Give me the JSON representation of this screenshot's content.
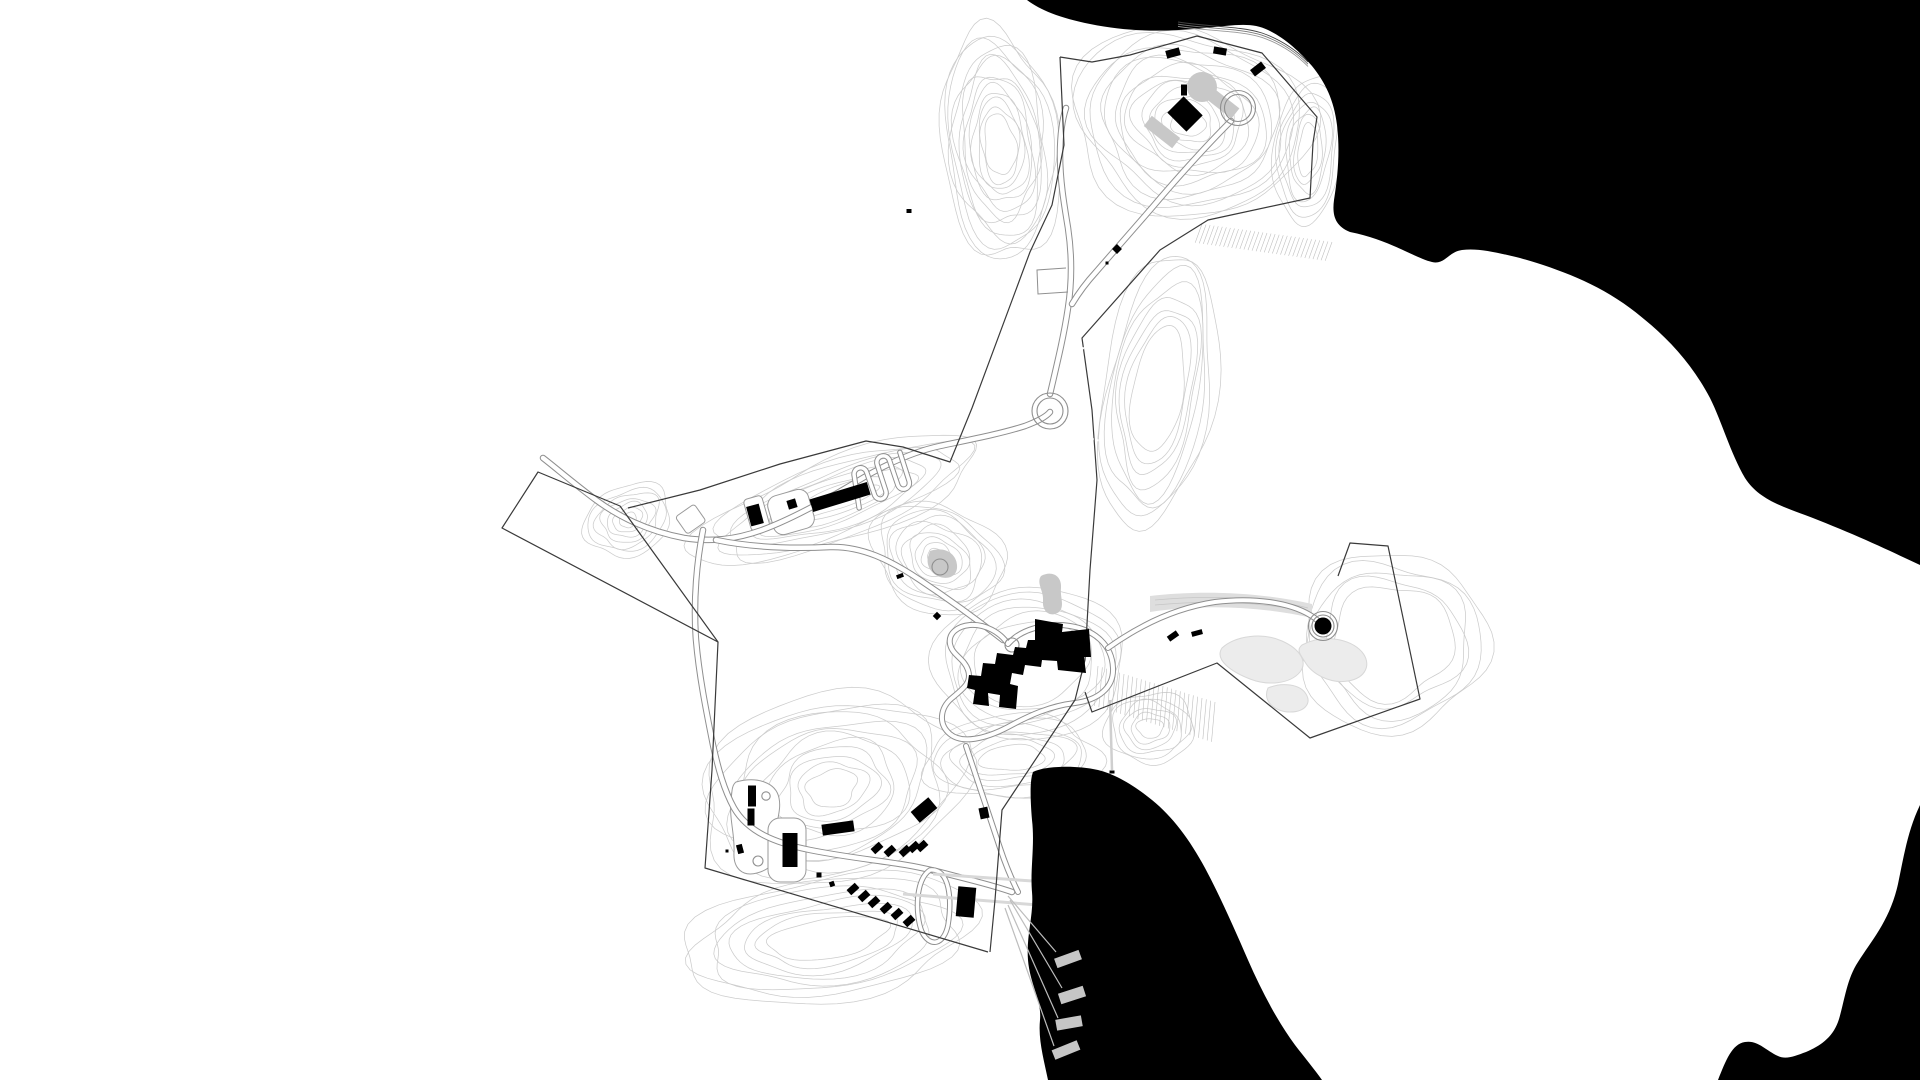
{
  "title": "site-plan-drawing",
  "canvas": {
    "width": 1920,
    "height": 1080,
    "background": "#ffffff"
  },
  "colors": {
    "water": "#000000",
    "building": "#000000",
    "contour": "#cccccc",
    "road_casing": "#8f8f8f",
    "road_fill": "#ffffff",
    "boundary": "#3a3a3a",
    "gray_surface": "#c8c8c8",
    "pond_light": "#ececec",
    "pond_stroke": "#d8d8d8",
    "band": "#dedede",
    "path_light": "#d8d8d8",
    "fan_line": "#bdbdbd",
    "pier": "#c6c6c6",
    "hatch": "#bfbfbf",
    "white_bldg_stroke": "#9a9a9a",
    "dash_white": "#ffffff"
  },
  "water_bodies": [
    {
      "name": "water-northeast-sea",
      "d": "M1027,0 C1040,10 1060,18 1090,24 C1130,32 1165,32 1205,28 C1235,25 1252,22 1268,30 C1285,38 1300,52 1312,66 C1325,82 1334,100 1337,125 C1340,150 1338,175 1334,200 C1332,215 1335,226 1350,232 C1390,240 1415,258 1432,262 C1445,265 1448,252 1462,250 C1478,248 1495,252 1520,258 C1555,268 1595,282 1630,308 C1662,332 1690,360 1710,398 C1722,422 1730,452 1745,478 C1758,498 1778,505 1805,515 C1842,529 1880,546 1905,558 L1920,565 L1920,0 Z"
    },
    {
      "name": "water-south-bay",
      "d": "M1033,772 C1045,766 1075,765 1098,770 C1115,774 1135,786 1152,800 C1172,816 1190,840 1205,868 C1220,896 1235,930 1248,960 C1262,992 1278,1022 1295,1045 C1305,1058 1315,1070 1322,1080 L1048,1080 C1044,1060 1038,1040 1040,1020 C1042,1000 1030,985 1028,960 C1026,935 1034,915 1032,892 C1030,870 1035,845 1032,820 C1030,795 1030,780 1033,772 Z"
    },
    {
      "name": "water-southeast-sea",
      "d": "M1920,805 C1908,830 1904,855 1898,884 C1890,920 1872,940 1858,962 C1846,980 1844,1005 1838,1022 C1832,1038 1820,1046 1806,1052 C1795,1056 1786,1060 1778,1056 C1765,1050 1758,1040 1745,1042 C1732,1044 1726,1060 1718,1080 L1920,1080 Z"
    }
  ],
  "shoreline_strokes": [
    {
      "d": "M1178,22 C1210,27 1240,26 1262,33 C1282,40 1296,50 1308,62",
      "dy": 0,
      "c": "#444444"
    },
    {
      "d": "M1178,22 C1210,27 1240,26 1262,33 C1282,40 1296,50 1308,62",
      "dy": 2.2,
      "c": "#777777"
    },
    {
      "d": "M1178,22 C1210,27 1240,26 1262,33 C1282,40 1296,50 1308,62",
      "dy": 4.4,
      "c": "#999999"
    }
  ],
  "contour_fields": [
    {
      "name": "contours-north-west",
      "cx": 1000,
      "cy": 145,
      "rx0": 16,
      "ry0": 30,
      "rx1": 58,
      "ry1": 118,
      "n": 13,
      "rot": -6,
      "wob": 1,
      "seed": 11
    },
    {
      "name": "contours-north-hilltop",
      "cx": 1188,
      "cy": 122,
      "rx0": 18,
      "ry0": 14,
      "rx1": 118,
      "ry1": 96,
      "n": 15,
      "rot": 12,
      "wob": 1,
      "seed": 22
    },
    {
      "name": "contours-nw-ridge",
      "cx": 838,
      "cy": 500,
      "rx0": 42,
      "ry0": 9,
      "rx1": 148,
      "ry1": 42,
      "n": 9,
      "rot": -20,
      "wob": 1,
      "seed": 33
    },
    {
      "name": "contours-west-knob",
      "cx": 628,
      "cy": 520,
      "rx0": 9,
      "ry0": 7,
      "rx1": 46,
      "ry1": 34,
      "n": 7,
      "rot": -25,
      "wob": 1,
      "seed": 44
    },
    {
      "name": "contours-central-knoll",
      "cx": 938,
      "cy": 558,
      "rx0": 11,
      "ry0": 9,
      "rx1": 68,
      "ry1": 54,
      "n": 10,
      "rot": 25,
      "wob": 1,
      "seed": 55
    },
    {
      "name": "contours-building-hill",
      "cx": 1030,
      "cy": 663,
      "rx0": 58,
      "ry0": 42,
      "rx1": 96,
      "ry1": 76,
      "n": 6,
      "rot": -8,
      "wob": 0.7,
      "seed": 66
    },
    {
      "name": "contours-south-of-bldg",
      "cx": 1012,
      "cy": 758,
      "rx0": 32,
      "ry0": 13,
      "rx1": 88,
      "ry1": 42,
      "n": 7,
      "rot": -4,
      "wob": 1,
      "seed": 77
    },
    {
      "name": "contours-ne-mid-slope",
      "cx": 1158,
      "cy": 390,
      "rx0": 26,
      "ry0": 62,
      "rx1": 56,
      "ry1": 140,
      "n": 8,
      "rot": 10,
      "wob": 0.8,
      "seed": 88
    },
    {
      "name": "contours-sw-hill",
      "cx": 832,
      "cy": 788,
      "rx0": 26,
      "ry0": 18,
      "rx1": 138,
      "ry1": 92,
      "n": 12,
      "rot": -15,
      "wob": 1,
      "seed": 99
    },
    {
      "name": "contours-south-slope",
      "cx": 828,
      "cy": 938,
      "rx0": 60,
      "ry0": 20,
      "rx1": 148,
      "ry1": 62,
      "n": 8,
      "rot": -8,
      "wob": 1,
      "seed": 110
    },
    {
      "name": "contours-east-rim",
      "cx": 1392,
      "cy": 642,
      "rx0": 62,
      "ry0": 56,
      "rx1": 96,
      "ry1": 88,
      "n": 5,
      "rot": 0,
      "wob": 1,
      "seed": 121
    },
    {
      "name": "contours-marina-knoll",
      "cx": 1150,
      "cy": 728,
      "rx0": 13,
      "ry0": 10,
      "rx1": 44,
      "ry1": 36,
      "n": 6,
      "rot": 0,
      "wob": 1,
      "seed": 132
    },
    {
      "name": "contours-ne-pocket",
      "cx": 1308,
      "cy": 150,
      "rx0": 10,
      "ry0": 26,
      "rx1": 34,
      "ry1": 74,
      "n": 7,
      "rot": 5,
      "wob": 0.8,
      "seed": 143
    }
  ],
  "hatch_bands": [
    {
      "name": "hatch-ne-coast",
      "x1": 1202,
      "y1": 224,
      "x2": 1332,
      "y2": 242,
      "len": 20,
      "angle": 110,
      "step": 4
    },
    {
      "name": "hatch-mid-east",
      "x1": 1098,
      "y1": 666,
      "x2": 1215,
      "y2": 702,
      "len": 40,
      "angle": 95,
      "step": 4.5
    }
  ],
  "gray_shapes": [
    {
      "name": "hilltop-plaza-circle",
      "type": "circle",
      "cx": 1202,
      "cy": 87,
      "r": 15,
      "fill": "#c8c8c8"
    },
    {
      "name": "hilltop-ramp-east",
      "type": "rect",
      "cx": 1222,
      "cy": 103,
      "w": 34,
      "h": 13,
      "rot": 38,
      "fill": "#c8c8c8"
    },
    {
      "name": "hilltop-ramp-west",
      "type": "rect",
      "cx": 1162,
      "cy": 132,
      "w": 36,
      "h": 13,
      "rot": 38,
      "fill": "#c8c8c8"
    },
    {
      "name": "pond-central",
      "type": "path",
      "d": "M1041,576 C1052,570 1062,576 1061,588 C1060,598 1065,606 1059,612 C1051,618 1042,612 1043,601 C1044,591 1036,583 1041,576 Z",
      "fill": "#c8c8c8"
    },
    {
      "name": "pond-knoll",
      "type": "path",
      "d": "M930,551 C944,546 956,553 957,565 C958,575 950,580 940,577 C931,574 926,565 928,557 Z",
      "fill": "#c8c8c8"
    },
    {
      "name": "east-track-band",
      "type": "path",
      "d": "M1150,596 C1200,590 1260,592 1312,604 L1312,618 C1260,606 1200,604 1150,612 Z",
      "fill": "#dedede"
    },
    {
      "name": "pond-east-1",
      "type": "path",
      "d": "M1222,648 C1235,636 1262,632 1282,641 C1300,649 1308,662 1300,672 C1290,684 1268,686 1250,679 C1232,672 1214,660 1222,648 Z",
      "fill": "#ececec",
      "stroke": "#d8d8d8"
    },
    {
      "name": "pond-east-2",
      "type": "path",
      "d": "M1302,645 C1322,634 1350,638 1362,652 C1372,664 1366,678 1348,681 C1330,684 1312,674 1305,662 C1300,654 1296,650 1302,645 Z",
      "fill": "#ececec",
      "stroke": "#d8d8d8"
    },
    {
      "name": "pond-east-3",
      "type": "path",
      "d": "M1268,688 C1282,682 1300,684 1306,694 C1312,704 1304,712 1290,712 C1276,712 1262,702 1268,688 Z",
      "fill": "#ececec",
      "stroke": "#d8d8d8"
    }
  ],
  "band_streaks": [
    {
      "d": "M1155,600 C1210,595 1265,597 1308,608"
    },
    {
      "d": "M1155,605 C1210,600 1265,602 1305,612"
    }
  ],
  "white_buildings": [
    {
      "name": "plaza-mid-row",
      "type": "rect",
      "x": 770,
      "y": 492,
      "w": 42,
      "h": 40,
      "rx": 10,
      "rot": -16,
      "cx": 791,
      "cy": 512
    },
    {
      "name": "white-bldg-left",
      "type": "rect",
      "x": 747,
      "y": 497,
      "w": 19,
      "h": 33,
      "rx": 4,
      "rot": -16,
      "cx": 756,
      "cy": 513
    },
    {
      "name": "white-bldg-far-left",
      "type": "rect",
      "x": 679,
      "y": 509,
      "w": 23,
      "h": 21,
      "rx": 3,
      "rot": -35,
      "cx": 690,
      "cy": 519
    },
    {
      "name": "sw-plaza-north",
      "type": "path",
      "d": "M736,782 C758,776 776,783 779,798 C782,812 774,824 777,840 C780,857 773,869 757,873 C742,877 733,868 734,852 C735,835 729,818 731,801 C732,790 732,785 736,782 Z"
    },
    {
      "name": "sw-plaza-south",
      "type": "rect",
      "x": 768,
      "y": 818,
      "w": 38,
      "h": 64,
      "rx": 12,
      "rot": 0,
      "cx": 787,
      "cy": 850
    }
  ],
  "roads": [
    {
      "name": "road-west-main",
      "w": 4.5,
      "d": "M543,458 C556,468 572,482 596,500 C622,519 652,532 684,538 C710,542 734,540 762,530 C792,519 826,500 856,482 C884,465 912,452 940,446 C968,440 1000,434 1025,426 C1038,421 1046,417 1050,412"
    },
    {
      "name": "road-central-access",
      "w": 4.5,
      "d": "M716,540 C750,547 790,549 830,547 C862,546 890,560 920,580 C950,600 980,622 1003,640"
    },
    {
      "name": "road-north",
      "w": 4.5,
      "d": "M1050,394 C1058,360 1064,335 1068,308 C1072,282 1072,255 1068,228 C1064,204 1060,180 1060,155 C1060,135 1062,120 1066,108"
    },
    {
      "name": "road-serpentine-hill",
      "w": 4.5,
      "d": "M1231,121 C1210,142 1188,166 1162,196 C1140,222 1115,250 1096,272 C1085,284 1078,294 1072,304"
    },
    {
      "name": "road-central-loop",
      "w": 4,
      "d": "M1008,644 C1020,630 1045,622 1070,626 C1095,630 1112,645 1113,668 C1114,688 1098,700 1075,703 C1050,706 1030,715 1008,727 C985,739 962,744 950,734 C938,724 940,708 952,698 C964,688 972,682 968,670 C964,658 952,655 950,644 C948,633 958,626 970,625 C985,624 1000,632 1008,644 Z"
    },
    {
      "name": "road-to-silo",
      "w": 4,
      "d": "M1108,648 C1140,625 1175,608 1215,602 C1255,597 1290,603 1310,615 C1317,619 1320,622 1322,626"
    },
    {
      "name": "road-southwest",
      "w": 4.5,
      "d": "M703,530 C697,560 693,600 696,640 C699,675 706,710 713,745 C718,768 724,790 734,808 C748,832 775,843 810,850 C845,857 875,860 900,864 C920,867 940,872 955,876 C975,881 995,886 1012,892"
    },
    {
      "name": "road-loop-to-marina",
      "w": 4,
      "d": "M966,746 C978,782 990,818 1000,848 C1006,866 1012,880 1018,892"
    },
    {
      "name": "road-sw-oval-loop",
      "w": 3.5,
      "d": "M930,870 C950,868 952,900 948,925 C944,945 930,948 922,932 C915,915 915,880 930,870 Z"
    },
    {
      "name": "road-switchback",
      "w": 3.5,
      "d": "M853,502 L856,470 C856,461 869,461 869,470 L871,492 C871,501 883,501 883,492 L881,464 C881,455 894,455 894,464 L896,488 C896,497 908,497 908,488 L906,458",
      "transform": "rotate(-14 880 480)"
    }
  ],
  "road_circles": [
    {
      "name": "hilltop-loop-outer",
      "cx": 1238,
      "cy": 108,
      "r": 17.5
    },
    {
      "name": "hilltop-loop-inner",
      "cx": 1238,
      "cy": 108,
      "r": 13.5
    },
    {
      "name": "turning-circle-outer",
      "cx": 1050,
      "cy": 411,
      "r": 18
    },
    {
      "name": "turning-circle-inner",
      "cx": 1050,
      "cy": 411,
      "r": 13
    },
    {
      "name": "roundabout",
      "cx": 1012,
      "cy": 645,
      "r": 7
    },
    {
      "name": "knoll-circle",
      "cx": 940,
      "cy": 567,
      "r": 8
    },
    {
      "name": "sw-circle-small",
      "cx": 766,
      "cy": 796,
      "r": 4.2
    },
    {
      "name": "sw-circle-lower",
      "cx": 758,
      "cy": 861,
      "r": 5
    },
    {
      "name": "silo-ring-outer",
      "cx": 1323,
      "cy": 626,
      "r": 14.5
    },
    {
      "name": "silo-ring-inner",
      "cx": 1323,
      "cy": 626,
      "r": 11
    }
  ],
  "thin_lines": [
    {
      "name": "plateau-spur",
      "d": "M1066,268 L1037,270 L1038,294 L1068,292",
      "c": "#8f8f8f",
      "w": 1
    },
    {
      "name": "shore-path-east",
      "d": "M1110,700 L1112,770",
      "c": "#cfcfcf",
      "w": 2.5
    }
  ],
  "light_paths": [
    {
      "name": "marina-path-1",
      "d": "M933,874 L1047,882",
      "w": 3
    },
    {
      "name": "marina-path-2",
      "d": "M903,894 L1050,906",
      "w": 3
    }
  ],
  "fan_lines": [
    {
      "d": "M1008,896 L1056,952"
    },
    {
      "d": "M1010,900 L1062,988"
    },
    {
      "d": "M1008,905 L1058,1018"
    },
    {
      "d": "M1005,908 L1054,1046"
    }
  ],
  "piers": [
    {
      "cx": 1068,
      "cy": 959,
      "w": 26,
      "h": 10,
      "rot": -20
    },
    {
      "cx": 1072,
      "cy": 995,
      "w": 26,
      "h": 11,
      "rot": -18
    },
    {
      "cx": 1069,
      "cy": 1023,
      "w": 26,
      "h": 11,
      "rot": -10
    },
    {
      "cx": 1066,
      "cy": 1050,
      "w": 27,
      "h": 10,
      "rot": -22
    }
  ],
  "boundary_lines": [
    {
      "name": "boundary-west-chain",
      "d": "M1060,57 L1064,145 L1052,205 L1030,252 L972,408 L950,462 L903,447 L866,441 L780,464 L700,490 L628,508"
    },
    {
      "name": "boundary-wedge",
      "d": "M538,472 L502,528 L718,642 L620,506 Z"
    },
    {
      "name": "boundary-southwest",
      "d": "M718,642 L712,770 L705,868 L988,952"
    },
    {
      "name": "boundary-northeast-chain",
      "d": "M1060,57 L1092,62 L1130,55 L1197,36 L1262,53 L1317,117 L1313,143 L1310,198 L1208,220 L1160,250 L1082,338 L1092,410 L1097,480 L1090,570 L1085,660 L1075,700 L1002,810 L995,900 L990,952"
    },
    {
      "name": "boundary-east-field",
      "d": "M1085,692 L1092,712 L1217,663 L1310,738 L1420,699 L1388,546 L1350,543 L1338,576"
    }
  ],
  "buildings": {
    "central_polygon": "M1035,619 L1063,624 L1062,632 L1089,629 L1091,657 L1084,657 L1086,673 L1058,670 L1057,661 L1042,660 L1041,667 L1025,665 L1023,675 L1012,673 L1010,684 L1018,686 L1016,709 L999,707 L1000,695 L988,693 L989,706 L973,704 L975,690 L967,688 L969,675 L981,676 L983,663 L995,664 L997,653 L1013,655 L1015,647 L1026,648 L1028,640 L1035,640 Z",
    "rects": [
      {
        "cx": 1173,
        "cy": 53,
        "w": 14,
        "h": 8,
        "rot": -15
      },
      {
        "cx": 1220,
        "cy": 51,
        "w": 13,
        "h": 7,
        "rot": 10
      },
      {
        "cx": 1258,
        "cy": 69,
        "w": 14,
        "h": 8,
        "rot": -38
      },
      {
        "cx": 1184,
        "cy": 90,
        "w": 6,
        "h": 11,
        "rot": 0
      },
      {
        "cx": 1185,
        "cy": 114,
        "w": 27,
        "h": 23,
        "rot": 45
      },
      {
        "cx": 840,
        "cy": 497,
        "w": 60,
        "h": 13,
        "rot": -17
      },
      {
        "cx": 792,
        "cy": 504,
        "w": 9,
        "h": 9,
        "rot": -17
      },
      {
        "cx": 755,
        "cy": 515,
        "w": 13,
        "h": 20,
        "rot": -15
      },
      {
        "cx": 900,
        "cy": 576,
        "w": 7,
        "h": 4,
        "rot": -20
      },
      {
        "cx": 937,
        "cy": 616,
        "w": 6,
        "h": 6,
        "rot": 45
      },
      {
        "cx": 1173,
        "cy": 636,
        "w": 11,
        "h": 6,
        "rot": -35
      },
      {
        "cx": 1197,
        "cy": 633,
        "w": 11,
        "h": 5,
        "rot": -15
      },
      {
        "cx": 752,
        "cy": 796,
        "w": 8,
        "h": 21,
        "rot": 0
      },
      {
        "cx": 751,
        "cy": 817,
        "w": 7,
        "h": 17,
        "rot": 0
      },
      {
        "cx": 740,
        "cy": 849,
        "w": 6,
        "h": 9,
        "rot": -15
      },
      {
        "cx": 727,
        "cy": 851,
        "w": 3,
        "h": 3,
        "rot": 0
      },
      {
        "cx": 790,
        "cy": 850,
        "w": 15,
        "h": 34,
        "rot": 0
      },
      {
        "cx": 838,
        "cy": 828,
        "w": 32,
        "h": 11,
        "rot": -8
      },
      {
        "cx": 924,
        "cy": 810,
        "w": 23,
        "h": 14,
        "rot": -40
      },
      {
        "cx": 984,
        "cy": 813,
        "w": 9,
        "h": 11,
        "rot": -12
      },
      {
        "cx": 966,
        "cy": 902,
        "w": 18,
        "h": 30,
        "rot": 5
      },
      {
        "cx": 877,
        "cy": 848,
        "w": 11,
        "h": 7,
        "rot": -42
      },
      {
        "cx": 890,
        "cy": 851,
        "w": 11,
        "h": 7,
        "rot": -42
      },
      {
        "cx": 905,
        "cy": 851,
        "w": 11,
        "h": 7,
        "rot": -42
      },
      {
        "cx": 914,
        "cy": 847,
        "w": 11,
        "h": 7,
        "rot": -42
      },
      {
        "cx": 922,
        "cy": 846,
        "w": 11,
        "h": 7,
        "rot": -42
      },
      {
        "cx": 853,
        "cy": 889,
        "w": 11,
        "h": 7,
        "rot": -42
      },
      {
        "cx": 864,
        "cy": 896,
        "w": 11,
        "h": 7,
        "rot": -42
      },
      {
        "cx": 874,
        "cy": 902,
        "w": 11,
        "h": 7,
        "rot": -42
      },
      {
        "cx": 886,
        "cy": 908,
        "w": 11,
        "h": 7,
        "rot": -42
      },
      {
        "cx": 897,
        "cy": 914,
        "w": 11,
        "h": 7,
        "rot": -42
      },
      {
        "cx": 909,
        "cy": 921,
        "w": 11,
        "h": 7,
        "rot": -42
      },
      {
        "cx": 819,
        "cy": 875,
        "w": 5,
        "h": 5,
        "rot": 0
      },
      {
        "cx": 832,
        "cy": 884,
        "w": 5,
        "h": 5,
        "rot": -20
      }
    ],
    "dots": [
      {
        "cx": 909,
        "cy": 211,
        "w": 5,
        "h": 4,
        "rot": 0
      },
      {
        "cx": 1117,
        "cy": 249,
        "w": 7,
        "h": 7,
        "rot": 45
      },
      {
        "cx": 1107,
        "cy": 263,
        "w": 3,
        "h": 3,
        "rot": 0
      },
      {
        "cx": 1112,
        "cy": 772,
        "w": 5,
        "h": 3,
        "rot": 0
      }
    ],
    "silo_dot": {
      "cx": 1323,
      "cy": 626,
      "r": 8.5
    }
  },
  "white_dashes": [
    {
      "d": "M1082,348 L1105,352"
    },
    {
      "d": "M1087,438 L1106,442"
    }
  ]
}
